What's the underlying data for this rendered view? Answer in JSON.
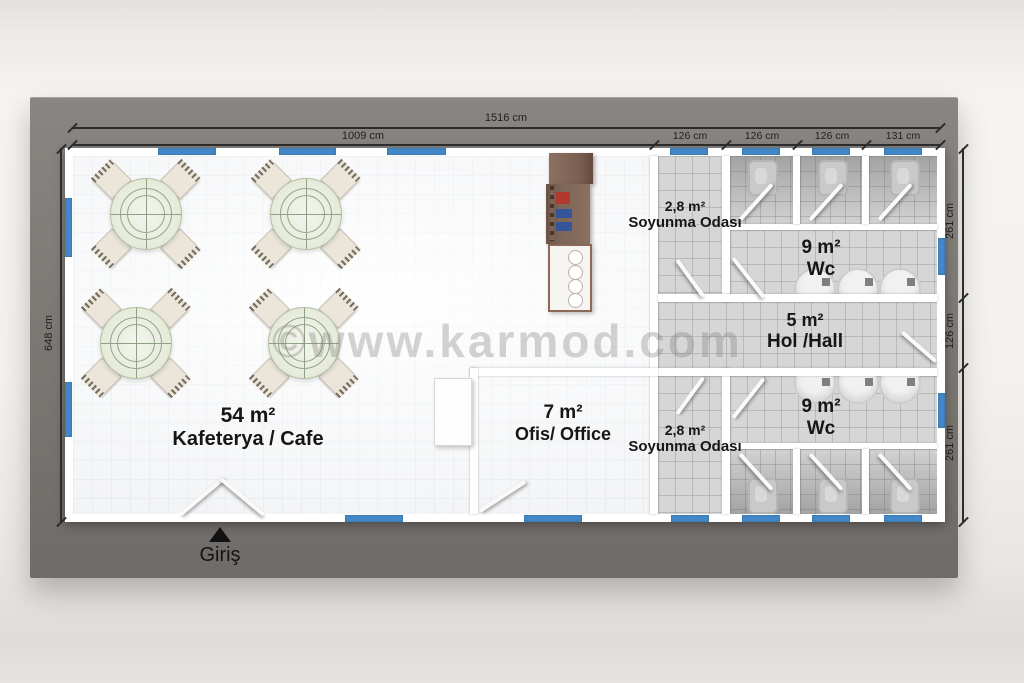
{
  "title": "Karmod prefabricated cafeteria floor plan",
  "watermark": {
    "text": "©www.karmod.com"
  },
  "entrance": {
    "label": "Giriş"
  },
  "dimensions": {
    "total_width": "1516 cm",
    "cafe_width": "1009 cm",
    "top_segments": [
      "126 cm",
      "126 cm",
      "126 cm",
      "131 cm"
    ],
    "left_height": "648 cm",
    "right_segments": [
      "261 cm",
      "126 cm",
      "261 cm"
    ]
  },
  "rooms": {
    "cafeteria": {
      "area": "54 m²",
      "name": "Kafeterya / Cafe"
    },
    "office": {
      "area": "7 m²",
      "name": "Ofis/ Office"
    },
    "soyunma_top": {
      "area": "2,8 m²",
      "name": "Soyunma Odası"
    },
    "soyunma_bottom": {
      "area": "2,8 m²",
      "name": "Soyunma Odası"
    },
    "wc_top": {
      "area": "9 m²",
      "name": "Wc"
    },
    "wc_bottom": {
      "area": "9 m²",
      "name": "Wc"
    },
    "hall": {
      "area": "5 m²",
      "name": "Hol /Hall"
    }
  },
  "colors": {
    "window_blue": "#4289c8",
    "slab_gray": "#7d7975",
    "floor_white": "#fcfcfc",
    "wet_room_gray": "#d6d6d6",
    "counter_brown": "#7a5f51",
    "dimension_ink": "#2c2c2c"
  }
}
